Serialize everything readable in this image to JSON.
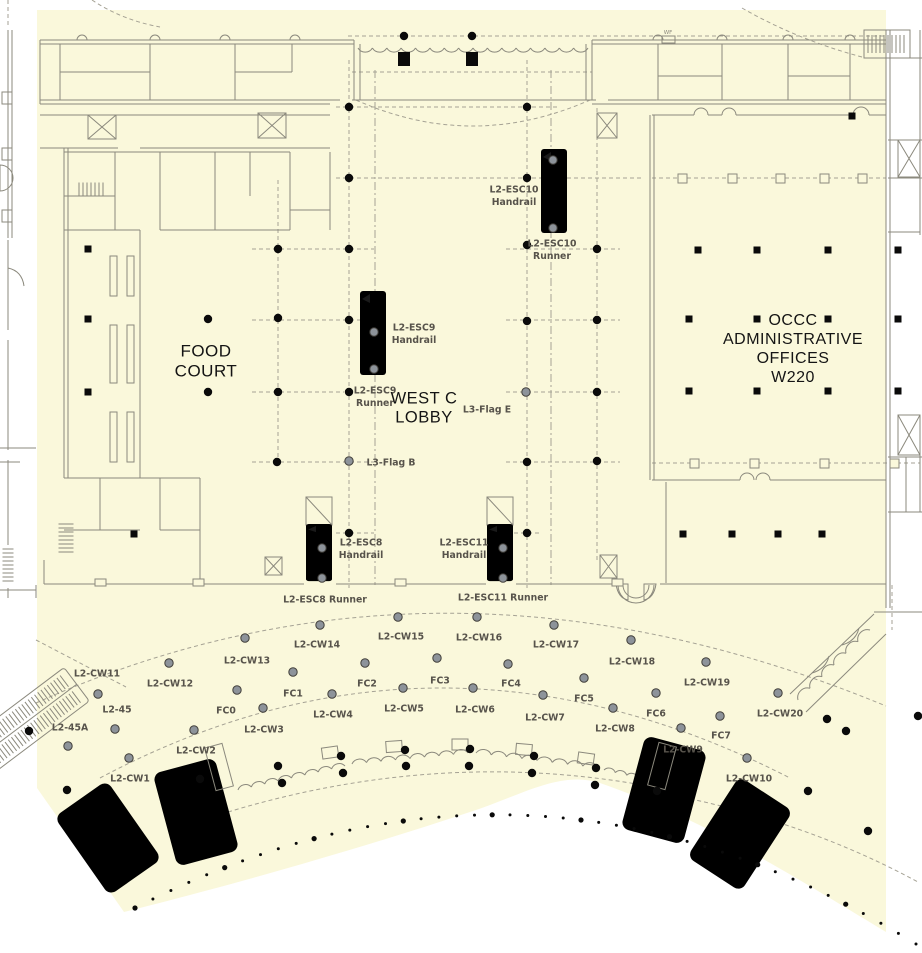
{
  "colors": {
    "highlight": "#FAF8DB",
    "wall": "#8B897D",
    "dash": "#A5A294",
    "label": "#57534B",
    "room_label": "#141414",
    "dot_black": "#0A0A0A",
    "dot_gray_fill": "#8D939A",
    "dot_gray_stroke": "#403E39",
    "dark_fill": "#6E6E64"
  },
  "room_labels": [
    {
      "id": "food-court",
      "lines": [
        "FOOD",
        "COURT"
      ],
      "x": 206,
      "y": 361,
      "size": 17
    },
    {
      "id": "west-c-lobby",
      "lines": [
        "WEST C",
        "LOBBY"
      ],
      "x": 424,
      "y": 408,
      "size": 16.5
    },
    {
      "id": "occc-administrative-offices",
      "lines": [
        "OCCC",
        "ADMINISTRATIVE",
        "OFFICES",
        "W220"
      ],
      "x": 793,
      "y": 349,
      "size": 16
    }
  ],
  "point_labels": [
    {
      "id": "l2-esc10-handrail",
      "lines": [
        "L2-ESC10",
        "Handrail"
      ],
      "x": 514,
      "y": 196
    },
    {
      "id": "l2-esc10-runner",
      "lines": [
        "L2-ESC10",
        "Runner"
      ],
      "x": 552,
      "y": 250
    },
    {
      "id": "l2-esc9-handrail",
      "lines": [
        "L2-ESC9",
        "Handrail"
      ],
      "x": 414,
      "y": 334
    },
    {
      "id": "l2-esc9-runner",
      "lines": [
        "L2-ESC9",
        "Runner"
      ],
      "x": 375,
      "y": 397
    },
    {
      "id": "l3-flag-e",
      "lines": [
        "L3-Flag E"
      ],
      "x": 487,
      "y": 410
    },
    {
      "id": "l3-flag-b",
      "lines": [
        "L3-Flag B"
      ],
      "x": 391,
      "y": 463
    },
    {
      "id": "l2-esc8-handrail",
      "lines": [
        "L2-ESC8",
        "Handrail"
      ],
      "x": 361,
      "y": 549
    },
    {
      "id": "l2-esc11-handrail",
      "lines": [
        "L2-ESC11",
        "Handrail"
      ],
      "x": 464,
      "y": 549
    },
    {
      "id": "l2-esc8-runner",
      "lines": [
        "L2-ESC8 Runner"
      ],
      "x": 325,
      "y": 600
    },
    {
      "id": "l2-esc11-runner",
      "lines": [
        "L2-ESC11 Runner"
      ],
      "x": 503,
      "y": 598
    },
    {
      "id": "l2-cw11",
      "lines": [
        "L2-CW11"
      ],
      "x": 97,
      "y": 674
    },
    {
      "id": "l2-cw12",
      "lines": [
        "L2-CW12"
      ],
      "x": 170,
      "y": 684
    },
    {
      "id": "l2-cw13",
      "lines": [
        "L2-CW13"
      ],
      "x": 247,
      "y": 661
    },
    {
      "id": "l2-cw14",
      "lines": [
        "L2-CW14"
      ],
      "x": 317,
      "y": 645
    },
    {
      "id": "l2-cw15",
      "lines": [
        "L2-CW15"
      ],
      "x": 401,
      "y": 637
    },
    {
      "id": "l2-cw16",
      "lines": [
        "L2-CW16"
      ],
      "x": 479,
      "y": 638
    },
    {
      "id": "l2-cw17",
      "lines": [
        "L2-CW17"
      ],
      "x": 556,
      "y": 645
    },
    {
      "id": "l2-cw18",
      "lines": [
        "L2-CW18"
      ],
      "x": 632,
      "y": 662
    },
    {
      "id": "l2-cw19",
      "lines": [
        "L2-CW19"
      ],
      "x": 707,
      "y": 683
    },
    {
      "id": "l2-cw20",
      "lines": [
        "L2-CW20"
      ],
      "x": 780,
      "y": 714
    },
    {
      "id": "l2-45",
      "lines": [
        "L2-45"
      ],
      "x": 117,
      "y": 710
    },
    {
      "id": "l2-45a",
      "lines": [
        "L2-45A"
      ],
      "x": 70,
      "y": 728
    },
    {
      "id": "l2-cw1",
      "lines": [
        "L2-CW1"
      ],
      "x": 130,
      "y": 779
    },
    {
      "id": "l2-cw2",
      "lines": [
        "L2-CW2"
      ],
      "x": 196,
      "y": 751
    },
    {
      "id": "l2-cw3",
      "lines": [
        "L2-CW3"
      ],
      "x": 264,
      "y": 730
    },
    {
      "id": "l2-cw4",
      "lines": [
        "L2-CW4"
      ],
      "x": 333,
      "y": 715
    },
    {
      "id": "l2-cw5",
      "lines": [
        "L2-CW5"
      ],
      "x": 404,
      "y": 709
    },
    {
      "id": "l2-cw6",
      "lines": [
        "L2-CW6"
      ],
      "x": 475,
      "y": 710
    },
    {
      "id": "l2-cw7",
      "lines": [
        "L2-CW7"
      ],
      "x": 545,
      "y": 718
    },
    {
      "id": "l2-cw8",
      "lines": [
        "L2-CW8"
      ],
      "x": 615,
      "y": 729
    },
    {
      "id": "l2-cw9",
      "lines": [
        "L2-CW9"
      ],
      "x": 683,
      "y": 750
    },
    {
      "id": "l2-cw10",
      "lines": [
        "L2-CW10"
      ],
      "x": 749,
      "y": 779
    },
    {
      "id": "fc0",
      "lines": [
        "FC0"
      ],
      "x": 226,
      "y": 711
    },
    {
      "id": "fc1",
      "lines": [
        "FC1"
      ],
      "x": 293,
      "y": 694
    },
    {
      "id": "fc2",
      "lines": [
        "FC2"
      ],
      "x": 367,
      "y": 684
    },
    {
      "id": "fc3",
      "lines": [
        "FC3"
      ],
      "x": 440,
      "y": 681
    },
    {
      "id": "fc4",
      "lines": [
        "FC4"
      ],
      "x": 511,
      "y": 684
    },
    {
      "id": "fc5",
      "lines": [
        "FC5"
      ],
      "x": 584,
      "y": 699
    },
    {
      "id": "fc6",
      "lines": [
        "FC6"
      ],
      "x": 656,
      "y": 714
    },
    {
      "id": "fc7",
      "lines": [
        "FC7"
      ],
      "x": 721,
      "y": 736
    }
  ],
  "tiny_labels": [
    {
      "id": "wf",
      "text": "WF",
      "x": 668,
      "y": 33
    }
  ],
  "dots": {
    "black": [
      [
        404,
        36
      ],
      [
        472,
        36
      ],
      [
        349,
        107
      ],
      [
        527,
        107
      ],
      [
        349,
        178
      ],
      [
        527,
        178
      ],
      [
        278,
        249
      ],
      [
        349,
        249
      ],
      [
        527,
        245
      ],
      [
        597,
        249
      ],
      [
        208,
        319
      ],
      [
        278,
        318
      ],
      [
        349,
        320
      ],
      [
        527,
        321
      ],
      [
        597,
        320
      ],
      [
        208,
        392
      ],
      [
        278,
        392
      ],
      [
        349,
        392
      ],
      [
        597,
        392
      ],
      [
        277,
        462
      ],
      [
        527,
        462
      ],
      [
        597,
        461
      ],
      [
        349,
        533
      ],
      [
        527,
        533
      ],
      [
        278,
        766
      ],
      [
        282,
        783
      ],
      [
        341,
        756
      ],
      [
        343,
        773
      ],
      [
        405,
        750
      ],
      [
        406,
        766
      ],
      [
        470,
        749
      ],
      [
        469,
        766
      ],
      [
        534,
        756
      ],
      [
        532,
        773
      ],
      [
        596,
        768
      ],
      [
        595,
        785
      ],
      [
        657,
        791
      ],
      [
        827,
        719
      ],
      [
        846,
        731
      ],
      [
        808,
        791
      ],
      [
        868,
        831
      ],
      [
        918,
        716
      ],
      [
        29,
        731
      ],
      [
        67,
        790
      ],
      [
        200,
        779
      ]
    ],
    "gray": [
      [
        98,
        694
      ],
      [
        169,
        663
      ],
      [
        245,
        638
      ],
      [
        320,
        625
      ],
      [
        398,
        617
      ],
      [
        477,
        617
      ],
      [
        554,
        625
      ],
      [
        631,
        640
      ],
      [
        706,
        662
      ],
      [
        778,
        693
      ],
      [
        129,
        758
      ],
      [
        194,
        730
      ],
      [
        263,
        708
      ],
      [
        332,
        694
      ],
      [
        403,
        688
      ],
      [
        473,
        688
      ],
      [
        543,
        695
      ],
      [
        613,
        708
      ],
      [
        681,
        728
      ],
      [
        747,
        758
      ],
      [
        237,
        690
      ],
      [
        293,
        672
      ],
      [
        365,
        663
      ],
      [
        437,
        658
      ],
      [
        508,
        664
      ],
      [
        584,
        678
      ],
      [
        656,
        693
      ],
      [
        720,
        716
      ],
      [
        115,
        729
      ],
      [
        68,
        746
      ],
      [
        374,
        332
      ],
      [
        374,
        369
      ],
      [
        553,
        160
      ],
      [
        553,
        228
      ],
      [
        322,
        548
      ],
      [
        322,
        578
      ],
      [
        503,
        548
      ],
      [
        503,
        578
      ],
      [
        349,
        461
      ],
      [
        526,
        392
      ]
    ],
    "squares": [
      [
        88,
        249
      ],
      [
        88,
        319
      ],
      [
        88,
        392
      ],
      [
        134,
        534
      ],
      [
        698,
        250
      ],
      [
        757,
        250
      ],
      [
        828,
        250
      ],
      [
        898,
        250
      ],
      [
        689,
        319
      ],
      [
        757,
        319
      ],
      [
        828,
        319
      ],
      [
        898,
        319
      ],
      [
        689,
        391
      ],
      [
        757,
        391
      ],
      [
        828,
        391
      ],
      [
        898,
        391
      ],
      [
        683,
        534
      ],
      [
        732,
        534
      ],
      [
        778,
        534
      ],
      [
        822,
        534
      ],
      [
        852,
        116
      ]
    ],
    "big_squares": [
      [
        404,
        59
      ],
      [
        472,
        59
      ]
    ]
  },
  "bottom_dot_arc": {
    "p0": [
      135,
      908
    ],
    "p1": [
      530,
      705
    ],
    "p2": [
      916,
      944
    ],
    "count": 44
  }
}
